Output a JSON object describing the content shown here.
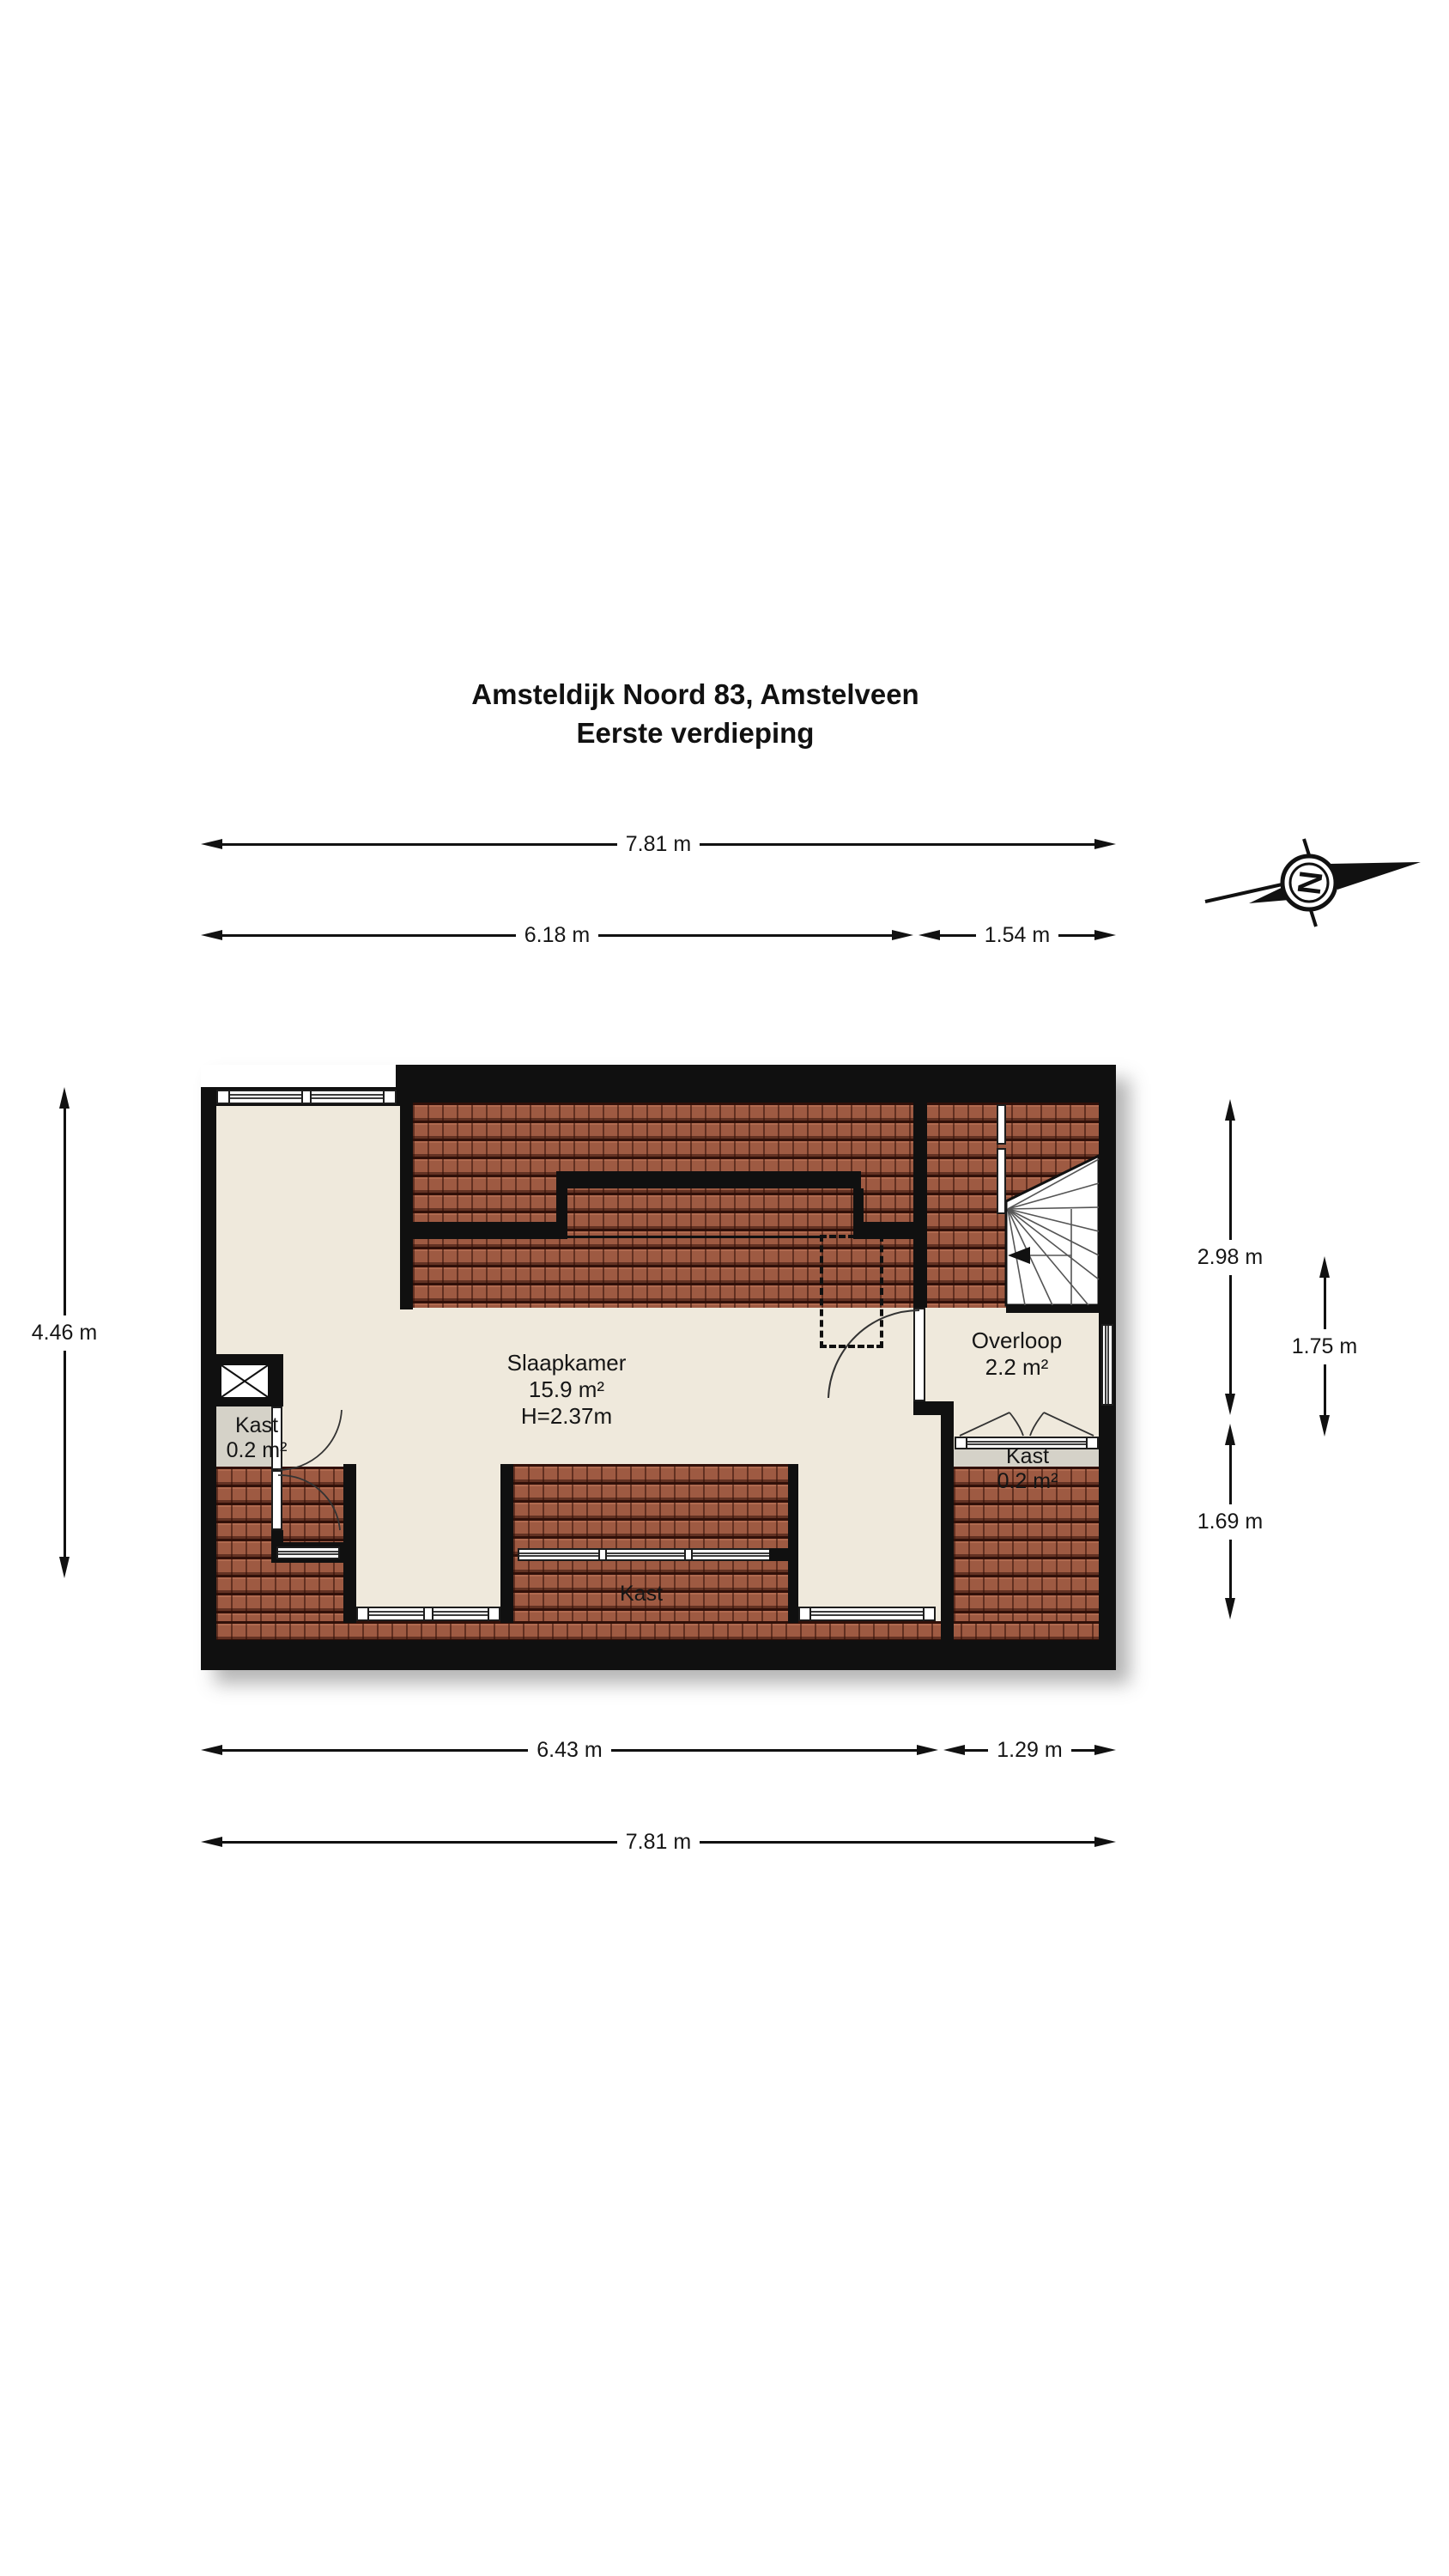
{
  "title": {
    "line1": "Amsteldijk Noord 83, Amstelveen",
    "line2": "Eerste verdieping"
  },
  "compass": {
    "letter": "N"
  },
  "dimensions": {
    "top_full": "7.81 m",
    "top_left": "6.18 m",
    "top_right": "1.54 m",
    "side_left": "4.46 m",
    "right_upper": "2.98 m",
    "right_inner": "1.75 m",
    "right_lower": "1.69 m",
    "bottom_left": "6.43 m",
    "bottom_right": "1.29 m",
    "bottom_full": "7.81 m"
  },
  "rooms": {
    "slaapkamer": {
      "name": "Slaapkamer",
      "area": "15.9 m²",
      "height": "H=2.37m"
    },
    "overloop": {
      "name": "Overloop",
      "area": "2.2 m²"
    },
    "kast_left": {
      "name": "Kast",
      "area": "0.2 m²"
    },
    "kast_right": {
      "name": "Kast",
      "area": "0.2 m²"
    },
    "kast_bottom": {
      "name": "Kast"
    }
  },
  "colors": {
    "wall": "#101010",
    "floor": "#efe9dc",
    "closet_floor": "#d5d2c8",
    "roof_tile": "#9e5a42",
    "roof_tile_dark": "#30100a"
  }
}
